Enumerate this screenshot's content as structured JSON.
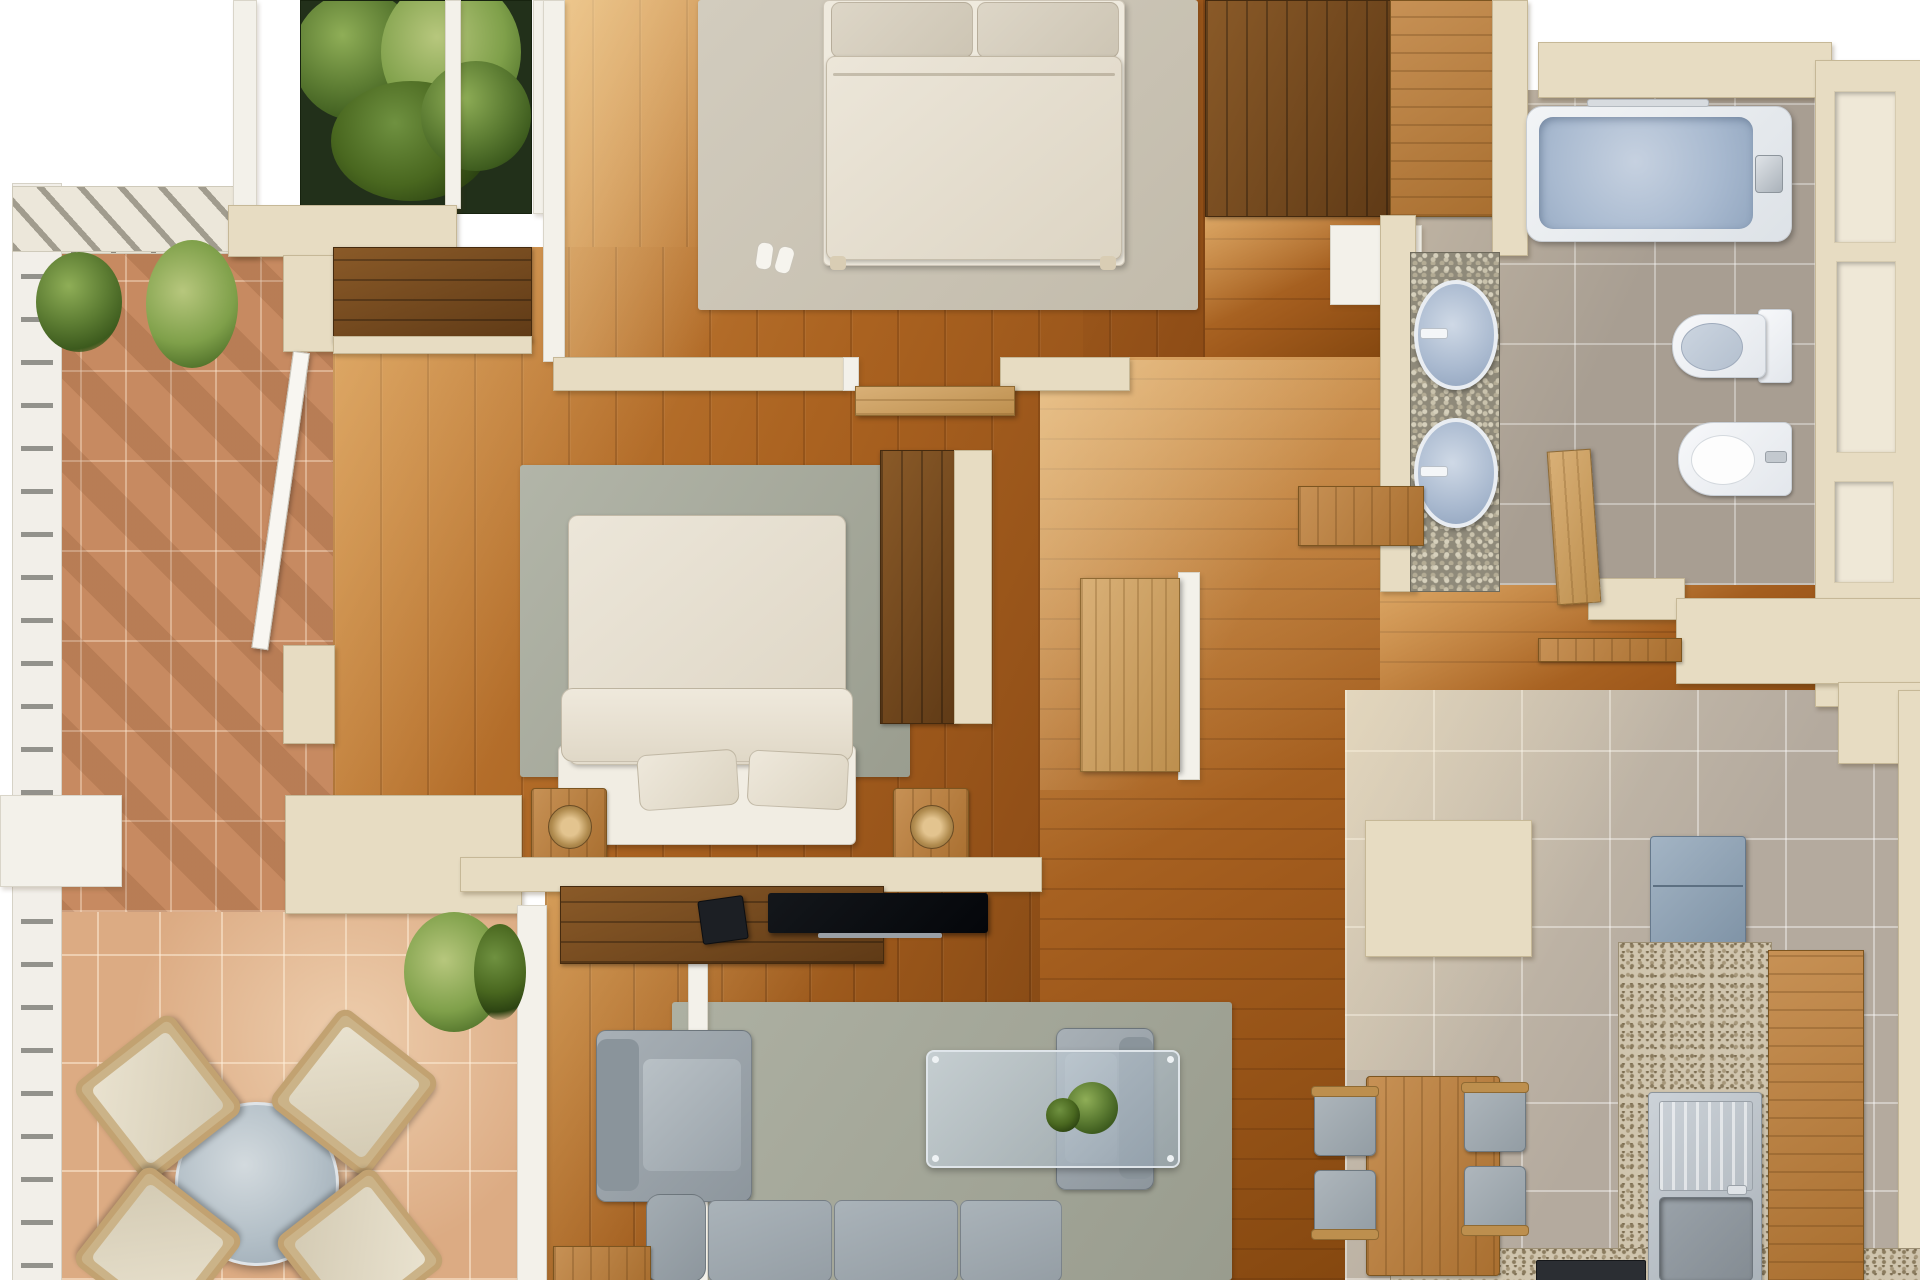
{
  "scene": {
    "title": "Apartment 3D floor plan — top-down render",
    "canvas": {
      "width": 1920,
      "height": 1280
    },
    "visible_text": ""
  },
  "palette": {
    "wall_cream": "#e7dcc2",
    "trim_white": "#f3f1ea",
    "wood_floor_light": "#c98740",
    "wood_floor_dark": "#8d4c16",
    "wood_floor_living": "#a25d1d",
    "wood_furniture": "#b5803f",
    "wood_cabinet_dark": "#6b4424",
    "door_oak": "#c99c5e",
    "terracotta_shaded": "#c78a61",
    "terracotta_sunlit": "#dcab83",
    "kitchen_tile": "#b4aa9e",
    "bath_tile": "#a89e92",
    "pebble_mosaic": "#8f8a7a",
    "granite": "#d0c5ae",
    "tub_blue": "#aebdd2",
    "fixture_white": "#f2f4f6",
    "steel": "#bcc3c9",
    "sofa_gray": "#99a2a9",
    "rug_gray_green": "#a6a99c",
    "rug_beige": "#cbc4b6",
    "bed_linen": "#e6dfd1",
    "plant_green": "#5d7d33",
    "glass_blue": "#bcc9d3",
    "railing_white": "#f2efe9"
  },
  "rooms": [
    {
      "id": "bedroom-1",
      "label": "Bedroom 1 — double bed on beige rug, wardrobes",
      "furniture": [
        "double bed",
        "beige area rug",
        "slippers",
        "dark wardrobe",
        "second closet"
      ]
    },
    {
      "id": "bedroom-2",
      "label": "Bedroom 2 — double bed, nightstands, closet band, bay window",
      "furniture": [
        "double bed",
        "two pillows",
        "two nightstands with round lamps",
        "gray-green rug",
        "built-in closet band",
        "tall wardrobe",
        "open casement window",
        "entry door"
      ]
    },
    {
      "id": "bathroom",
      "label": "Bathroom — bathtub, double vanity, toilet, bidet",
      "furniture": [
        "bathtub with chrome faucet",
        "pebble vanity with two blue basins",
        "toilet",
        "bidet",
        "wooden entry door",
        "wall niches",
        "wooden ledge"
      ]
    },
    {
      "id": "hallway",
      "label": "Hallway connecting bedrooms, bathroom, kitchen and living room",
      "furniture": [
        "bedroom door leafs",
        "console shelf"
      ]
    },
    {
      "id": "living-room",
      "label": "Living room — sofa, armchairs, glass coffee table, TV",
      "furniture": [
        "three-seat sofa",
        "two armchairs",
        "glass coffee table with plant",
        "TV on dark media console",
        "black media box",
        "wooden side table",
        "gray-green rug",
        "sliding door to terrace"
      ]
    },
    {
      "id": "kitchen",
      "label": "Kitchen and dining — table, chairs, sink, fridge, counters",
      "furniture": [
        "wooden dining table",
        "four chairs",
        "cream island block",
        "blue-gray refrigerator",
        "granite countertop",
        "wooden base cabinets",
        "stainless sink with drainboard",
        "dark cooktop"
      ]
    },
    {
      "id": "terrace",
      "label": "Terrace — outdoor dining set, plants, railing, pergola",
      "furniture": [
        "round glass table",
        "four cushioned chairs",
        "terracotta pavers",
        "white railing",
        "pergola slats",
        "planter with plants",
        "potted shrubs"
      ]
    }
  ]
}
